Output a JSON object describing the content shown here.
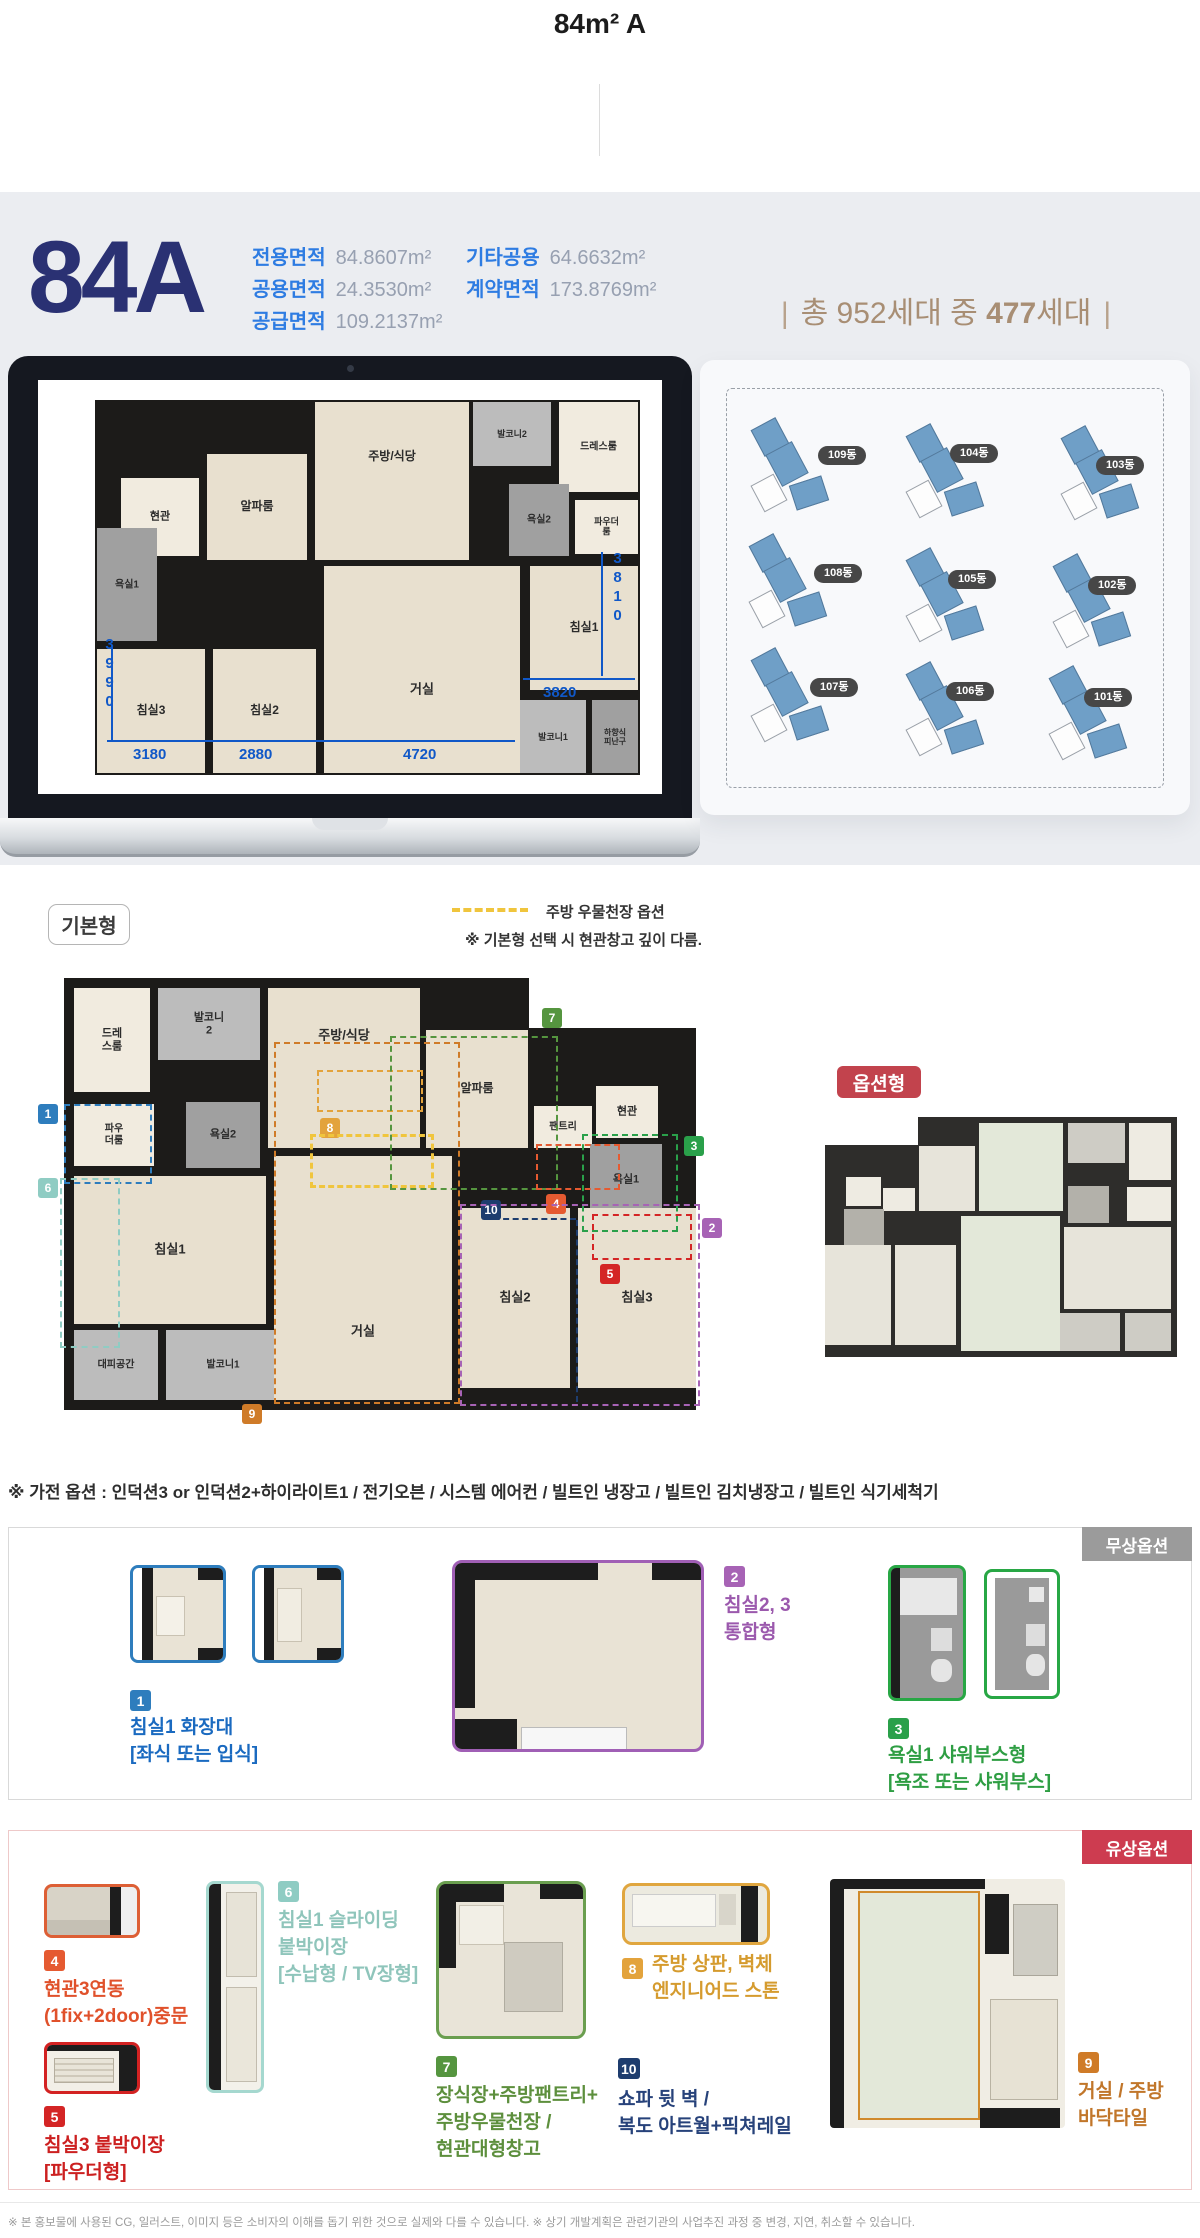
{
  "header": {
    "title": "84m² A"
  },
  "hero": {
    "unit_code": "84A",
    "areas": [
      {
        "label": "전용면적",
        "value": "84.8607m²"
      },
      {
        "label": "공용면적",
        "value": "24.3530m²"
      },
      {
        "label": "공급면적",
        "value": "109.2137m²"
      },
      {
        "label": "기타공용",
        "value": "64.6632m²"
      },
      {
        "label": "계약면적",
        "value": "173.8769m²"
      }
    ],
    "household": {
      "open": "|",
      "before": "총 952세대 중",
      "strong": "477",
      "after": "세대",
      "close": "|"
    }
  },
  "site_map": {
    "buildings": [
      {
        "label": "109동",
        "bx": 50,
        "by": 62,
        "px": 118,
        "py": 86
      },
      {
        "label": "104동",
        "bx": 205,
        "by": 68,
        "px": 250,
        "py": 84
      },
      {
        "label": "103동",
        "bx": 360,
        "by": 70,
        "px": 396,
        "py": 96
      },
      {
        "label": "108동",
        "bx": 48,
        "by": 178,
        "px": 114,
        "py": 204
      },
      {
        "label": "105동",
        "bx": 205,
        "by": 192,
        "px": 248,
        "py": 210
      },
      {
        "label": "102동",
        "bx": 352,
        "by": 198,
        "px": 388,
        "py": 216
      },
      {
        "label": "107동",
        "bx": 50,
        "by": 292,
        "px": 110,
        "py": 318
      },
      {
        "label": "106동",
        "bx": 205,
        "by": 306,
        "px": 246,
        "py": 322
      },
      {
        "label": "101동",
        "bx": 348,
        "by": 310,
        "px": 384,
        "py": 328
      }
    ]
  },
  "plans": {
    "laptop": {
      "w": 545,
      "h": 375,
      "slabs": [
        [
          0,
          0,
          545,
          375
        ]
      ],
      "rooms": [
        [
          378,
          2,
          78,
          64,
          "gray",
          "발코니2",
          9
        ],
        [
          464,
          2,
          79,
          90,
          "light",
          "드레스룸",
          10
        ],
        [
          220,
          2,
          154,
          158,
          "beige",
          "주방/식당",
          12,
          0.5,
          0.35
        ],
        [
          112,
          54,
          100,
          106,
          "beige",
          "알파룸",
          12
        ],
        [
          26,
          78,
          78,
          78,
          "light",
          "현관",
          11
        ],
        [
          414,
          84,
          60,
          72,
          "gray2",
          "욕실2",
          10
        ],
        [
          480,
          100,
          63,
          54,
          "light",
          "파우더룸",
          9
        ],
        [
          2,
          128,
          60,
          113,
          "gray2",
          "욕실1",
          10
        ],
        [
          2,
          249,
          108,
          124,
          "beige",
          "침실3",
          12
        ],
        [
          118,
          249,
          103,
          124,
          "beige",
          "침실2",
          12
        ],
        [
          229,
          166,
          196,
          207,
          "beige",
          "거실",
          13,
          0.5,
          0.6
        ],
        [
          435,
          166,
          108,
          124,
          "beige",
          "침실1",
          12
        ],
        [
          425,
          300,
          66,
          73,
          "gray",
          "발코니1",
          9
        ],
        [
          497,
          300,
          46,
          73,
          "gray2",
          "하향식\n피난구",
          8
        ]
      ],
      "dims": {
        "texts": [
          [
            "3990",
            6,
            236,
            1
          ],
          [
            "3180",
            38,
            346,
            0
          ],
          [
            "2880",
            144,
            346,
            0
          ],
          [
            "4720",
            308,
            346,
            0
          ],
          [
            "3820",
            448,
            284,
            0
          ],
          [
            "3810",
            514,
            150,
            1
          ]
        ],
        "lines": [
          [
            12,
            340,
            408,
            0
          ],
          [
            16,
            246,
            0,
            96
          ],
          [
            428,
            278,
            112,
            0
          ],
          [
            506,
            152,
            0,
            124
          ]
        ]
      }
    },
    "base": {
      "w": 632,
      "h": 432,
      "slabs": [
        [
          0,
          0,
          465,
          432
        ],
        [
          458,
          50,
          174,
          382
        ]
      ],
      "rooms": [
        [
          10,
          10,
          76,
          104,
          "light",
          "드레\n스룸",
          11
        ],
        [
          94,
          10,
          102,
          72,
          "gray",
          "발코니\n2",
          11
        ],
        [
          204,
          10,
          152,
          160,
          "beige",
          "주방/식당",
          13,
          0.5,
          0.3
        ],
        [
          362,
          52,
          102,
          118,
          "beige",
          "알파룸",
          12
        ],
        [
          470,
          128,
          58,
          42,
          "light",
          "팬트리",
          10
        ],
        [
          532,
          108,
          62,
          52,
          "light",
          "현관",
          11
        ],
        [
          122,
          124,
          74,
          66,
          "gray2",
          "욕실2",
          11
        ],
        [
          10,
          126,
          80,
          62,
          "light",
          "파우\n더룸",
          10
        ],
        [
          526,
          166,
          72,
          72,
          "gray2",
          "욕실1",
          11
        ],
        [
          10,
          198,
          192,
          148,
          "beige",
          "침실1",
          13
        ],
        [
          10,
          352,
          84,
          70,
          "gray",
          "대피공간",
          10
        ],
        [
          102,
          352,
          114,
          70,
          "gray",
          "발코니1",
          10
        ],
        [
          210,
          178,
          178,
          244,
          "beige",
          "거실",
          13,
          0.5,
          0.72
        ],
        [
          396,
          230,
          110,
          180,
          "beige",
          "침실2",
          13
        ],
        [
          514,
          230,
          118,
          180,
          "beige",
          "침실3",
          13
        ]
      ],
      "markers": [
        {
          "n": "1",
          "c": "#2e7dbd",
          "box": [
            0,
            126,
            84,
            76
          ],
          "badge": [
            -26,
            126
          ]
        },
        {
          "n": "6",
          "c": "#8fccc3",
          "box": [
            -4,
            200,
            56,
            166
          ],
          "badge": [
            -26,
            200
          ]
        },
        {
          "n": "8",
          "c": "#e3a33c",
          "box": [
            253,
            92,
            102,
            38
          ],
          "badge": [
            256,
            140
          ]
        },
        {
          "n": "",
          "c": "#f0c53d",
          "box": [
            246,
            156,
            118,
            48
          ],
          "bw": 3
        },
        {
          "n": "9",
          "c": "#cf7b28",
          "box": [
            210,
            64,
            182,
            358
          ],
          "badge": [
            178,
            426
          ]
        },
        {
          "n": "7",
          "c": "#55953f",
          "box": [
            326,
            58,
            164,
            150
          ],
          "badge": [
            478,
            30
          ]
        },
        {
          "n": "4",
          "c": "#e55a31",
          "box": [
            472,
            166,
            80,
            42
          ],
          "badge": [
            482,
            216
          ]
        },
        {
          "n": "10",
          "c": "#1e3d6e",
          "badge": [
            417,
            222
          ],
          "lines": [
            [
              420,
              240,
              92,
              0
            ],
            [
              512,
              242,
              0,
              182
            ]
          ]
        },
        {
          "n": "3",
          "c": "#2aa04a",
          "box": [
            518,
            156,
            92,
            94
          ],
          "badge": [
            620,
            158
          ]
        },
        {
          "n": "2",
          "c": "#a763b5",
          "box": [
            396,
            226,
            236,
            198
          ],
          "badge": [
            638,
            240
          ]
        },
        {
          "n": "5",
          "c": "#d42525",
          "box": [
            528,
            236,
            96,
            42
          ],
          "badge": [
            536,
            286
          ]
        }
      ]
    }
  },
  "base_section": {
    "tag": "기본형",
    "legend_label": "주방 우물천장 옵션",
    "note": "※ 기본형 선택 시 현관창고 깊이 다름.",
    "option_tag": "옵션형"
  },
  "notes": {
    "appliance": "※ 가전 옵션 : 인덕션3 or 인덕션2+하이라이트1 / 전기오븐 / 시스템 에어컨 / 빌트인 냉장고 / 빌트인 김치냉장고 / 빌트인 식기세척기",
    "disclaimer": "※ 본 홍보물에 사용된 CG, 일러스트, 이미지 등은 소비자의 이해를 돕기 위한 것으로 실제와 다를 수 있습니다. ※ 상기 개발계획은 관련기관의 사업추진 과정 중 변경, 지연, 취소할 수 있습니다."
  },
  "free_options": {
    "badge": "무상옵션",
    "items": [
      {
        "no": "1",
        "lines": [
          "침실1 화장대",
          "[좌식 또는 입식]"
        ]
      },
      {
        "no": "2",
        "lines": [
          "침실2, 3",
          "통합형"
        ]
      },
      {
        "no": "3",
        "lines": [
          "욕실1 샤워부스형",
          "[욕조 또는 샤워부스]"
        ]
      }
    ]
  },
  "paid_options": {
    "badge": "유상옵션",
    "items": [
      {
        "no": "4",
        "lines": [
          "현관3연동",
          "(1fix+2door)중문"
        ]
      },
      {
        "no": "5",
        "lines": [
          "침실3 붙박이장",
          "[파우더형]"
        ]
      },
      {
        "no": "6",
        "lines": [
          "침실1 슬라이딩",
          "붙박이장",
          "[수납형 / TV장형]"
        ]
      },
      {
        "no": "7",
        "lines": [
          "장식장+주방팬트리+",
          "주방우물천장 /",
          "현관대형창고"
        ]
      },
      {
        "no": "8",
        "lines": [
          "주방 상판, 벽체",
          "엔지니어드 스톤"
        ]
      },
      {
        "no": "10",
        "lines": [
          "쇼파 뒷 벽 /",
          "복도 아트월+픽쳐레일"
        ]
      },
      {
        "no": "9",
        "lines": [
          "거실 / 주방",
          "바닥타일"
        ]
      }
    ]
  }
}
